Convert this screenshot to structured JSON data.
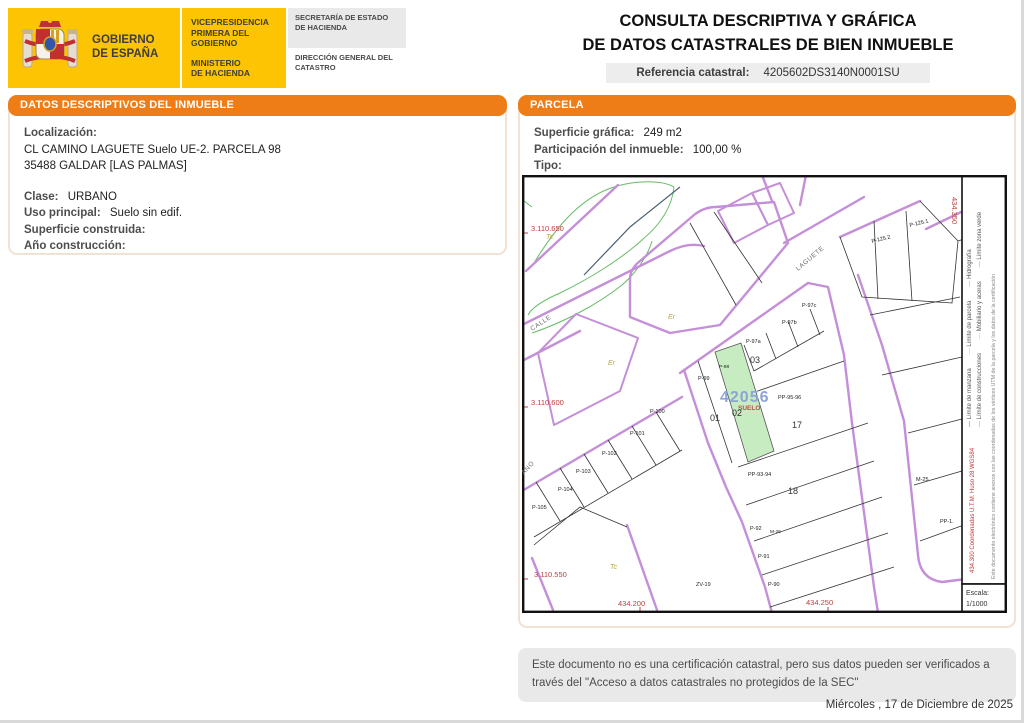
{
  "header": {
    "gov_line1": "GOBIERNO",
    "gov_line2": "DE ESPAÑA",
    "dept_line1": "VICEPRESIDENCIA",
    "dept_line2": "PRIMERA DEL GOBIERNO",
    "ministry_line1": "MINISTERIO",
    "ministry_line2": "DE HACIENDA",
    "secretary": "SECRETARÍA DE ESTADO DE HACIENDA",
    "directorate": "DIRECCIÓN GENERAL DEL CATASTRO",
    "title_line1": "CONSULTA DESCRIPTIVA Y GRÁFICA",
    "title_line2": "DE DATOS CATASTRALES DE BIEN INMUEBLE",
    "ref_label": "Referencia catastral:",
    "ref_value": "4205602DS3140N0001SU"
  },
  "left_panel": {
    "header": "DATOS DESCRIPTIVOS DEL INMUEBLE",
    "localizacion_label": "Localización:",
    "localizacion_line1": "CL CAMINO LAGUETE  Suelo UE-2. PARCELA 98",
    "localizacion_line2": "35488 GALDAR [LAS PALMAS]",
    "clase_label": "Clase:",
    "clase_value": "URBANO",
    "uso_label": "Uso principal:",
    "uso_value": "Suelo sin edif.",
    "superficie_label": "Superficie construida:",
    "superficie_value": "",
    "anio_label": "Año construcción:",
    "anio_value": ""
  },
  "parcel_panel": {
    "header": "PARCELA",
    "superficie_label": "Superficie gráfica:",
    "superficie_value": "249 m2",
    "participacion_label": "Participación del inmueble:",
    "participacion_value": "100,00 %",
    "tipo_label": "Tipo:",
    "tipo_value": ""
  },
  "map": {
    "scale_label": "Escala:",
    "scale_value": "1/1000",
    "highlight_block_number": "42056",
    "highlight_tag": "SUELO",
    "colors": {
      "street_boundary": "#c48fd8",
      "highlight_fill": "#c8ecc2",
      "coordinate_text": "#b84040",
      "block_number_text": "#8ca4d6"
    },
    "legend": {
      "row1": [
        {
          "name": "Límite de manzana",
          "color": "#b27fd0",
          "thick": true
        },
        {
          "name": "Límite de parcela",
          "color": "#cf9fe0",
          "thick": false
        },
        {
          "name": "Hidrografía",
          "color": "#7aa7d6",
          "thick": false
        }
      ],
      "row2": [
        {
          "name": "Límite de construcciones",
          "color": "#999999",
          "thick": false
        },
        {
          "name": "Mobiliario y aceras",
          "color": "#bbbbbb",
          "thick": false
        },
        {
          "name": "Límite zona verde",
          "color": "#69b869",
          "thick": false
        }
      ],
      "utm_note": "434.300 Coordenadas U.T.M. Huso 28 WGS84",
      "annex_note": "Este documento electrónico contiene anexos con las coordenadas de los vértices UTM de la parcela y los datos de la certificación"
    },
    "labels": [
      {
        "t": "3.110.650",
        "x": 9,
        "y": 56,
        "c": "coord"
      },
      {
        "t": "3.110.600",
        "x": 9,
        "y": 230,
        "c": "coord"
      },
      {
        "t": "3.110.550",
        "x": 12,
        "y": 402,
        "c": "coord"
      },
      {
        "t": "434.200",
        "x": 96,
        "y": 431,
        "c": "coord"
      },
      {
        "t": "434.250",
        "x": 284,
        "y": 430,
        "c": "coord"
      },
      {
        "t": "434.350",
        "x": 430,
        "y": 22,
        "c": "coord",
        "r": 90
      },
      {
        "t": "CALLE",
        "x": 10,
        "y": 156,
        "c": "street",
        "r": -33
      },
      {
        "t": "ANO",
        "x": 2,
        "y": 300,
        "c": "street",
        "r": -48
      },
      {
        "t": "LAGUETE",
        "x": 276,
        "y": 96,
        "c": "street",
        "r": -40
      },
      {
        "t": "Tc",
        "x": 24,
        "y": 64,
        "c": "olive"
      },
      {
        "t": "Er",
        "x": 146,
        "y": 144,
        "c": "olive"
      },
      {
        "t": "Er",
        "x": 86,
        "y": 190,
        "c": "olive"
      },
      {
        "t": "Tc",
        "x": 88,
        "y": 394,
        "c": "olive"
      },
      {
        "t": "P-125.2",
        "x": 350,
        "y": 68,
        "c": "pl",
        "r": -14
      },
      {
        "t": "P-125.1",
        "x": 388,
        "y": 52,
        "c": "pl",
        "r": -14
      },
      {
        "t": "P-97c",
        "x": 280,
        "y": 132,
        "c": "pl"
      },
      {
        "t": "P-97b",
        "x": 260,
        "y": 149,
        "c": "pl"
      },
      {
        "t": "P-97a",
        "x": 224,
        "y": 168,
        "c": "pl"
      },
      {
        "t": "03",
        "x": 228,
        "y": 188,
        "c": "num"
      },
      {
        "t": "P-98",
        "x": 197,
        "y": 193,
        "c": "pls"
      },
      {
        "t": "P-99",
        "x": 176,
        "y": 205,
        "c": "pl"
      },
      {
        "t": "42056",
        "x": 198,
        "y": 227,
        "c": "blk"
      },
      {
        "t": "SUELO",
        "x": 216,
        "y": 235,
        "c": "suelo"
      },
      {
        "t": "PP-95-96",
        "x": 256,
        "y": 224,
        "c": "pl"
      },
      {
        "t": "02",
        "x": 210,
        "y": 241,
        "c": "num"
      },
      {
        "t": "01",
        "x": 188,
        "y": 246,
        "c": "num"
      },
      {
        "t": "17",
        "x": 270,
        "y": 253,
        "c": "num"
      },
      {
        "t": "P-100",
        "x": 128,
        "y": 238,
        "c": "pl"
      },
      {
        "t": "P-101",
        "x": 108,
        "y": 260,
        "c": "pl"
      },
      {
        "t": "P-102",
        "x": 80,
        "y": 280,
        "c": "pl"
      },
      {
        "t": "P-103",
        "x": 54,
        "y": 298,
        "c": "pl"
      },
      {
        "t": "P-104",
        "x": 36,
        "y": 316,
        "c": "pl"
      },
      {
        "t": "P-105",
        "x": 10,
        "y": 334,
        "c": "pl"
      },
      {
        "t": "PP-93-94",
        "x": 226,
        "y": 301,
        "c": "pl"
      },
      {
        "t": "18",
        "x": 266,
        "y": 319,
        "c": "num"
      },
      {
        "t": "M-25",
        "x": 394,
        "y": 306,
        "c": "pl"
      },
      {
        "t": "PP-1.",
        "x": 418,
        "y": 348,
        "c": "pl"
      },
      {
        "t": "P-92",
        "x": 228,
        "y": 355,
        "c": "pl"
      },
      {
        "t": "M-26",
        "x": 248,
        "y": 358,
        "c": "pls"
      },
      {
        "t": "P-91",
        "x": 236,
        "y": 383,
        "c": "pl"
      },
      {
        "t": "P-90",
        "x": 246,
        "y": 411,
        "c": "pl"
      },
      {
        "t": "ZV-19",
        "x": 174,
        "y": 411,
        "c": "pl"
      }
    ]
  },
  "footer": {
    "disclaimer_line1": "Este documento no es una certificación catastral, pero sus datos pueden ser verificados a",
    "disclaimer_line2": "través del \"Acceso a datos catastrales no protegidos de la SEC\"",
    "date": "Miércoles , 17 de Diciembre de 2025"
  }
}
